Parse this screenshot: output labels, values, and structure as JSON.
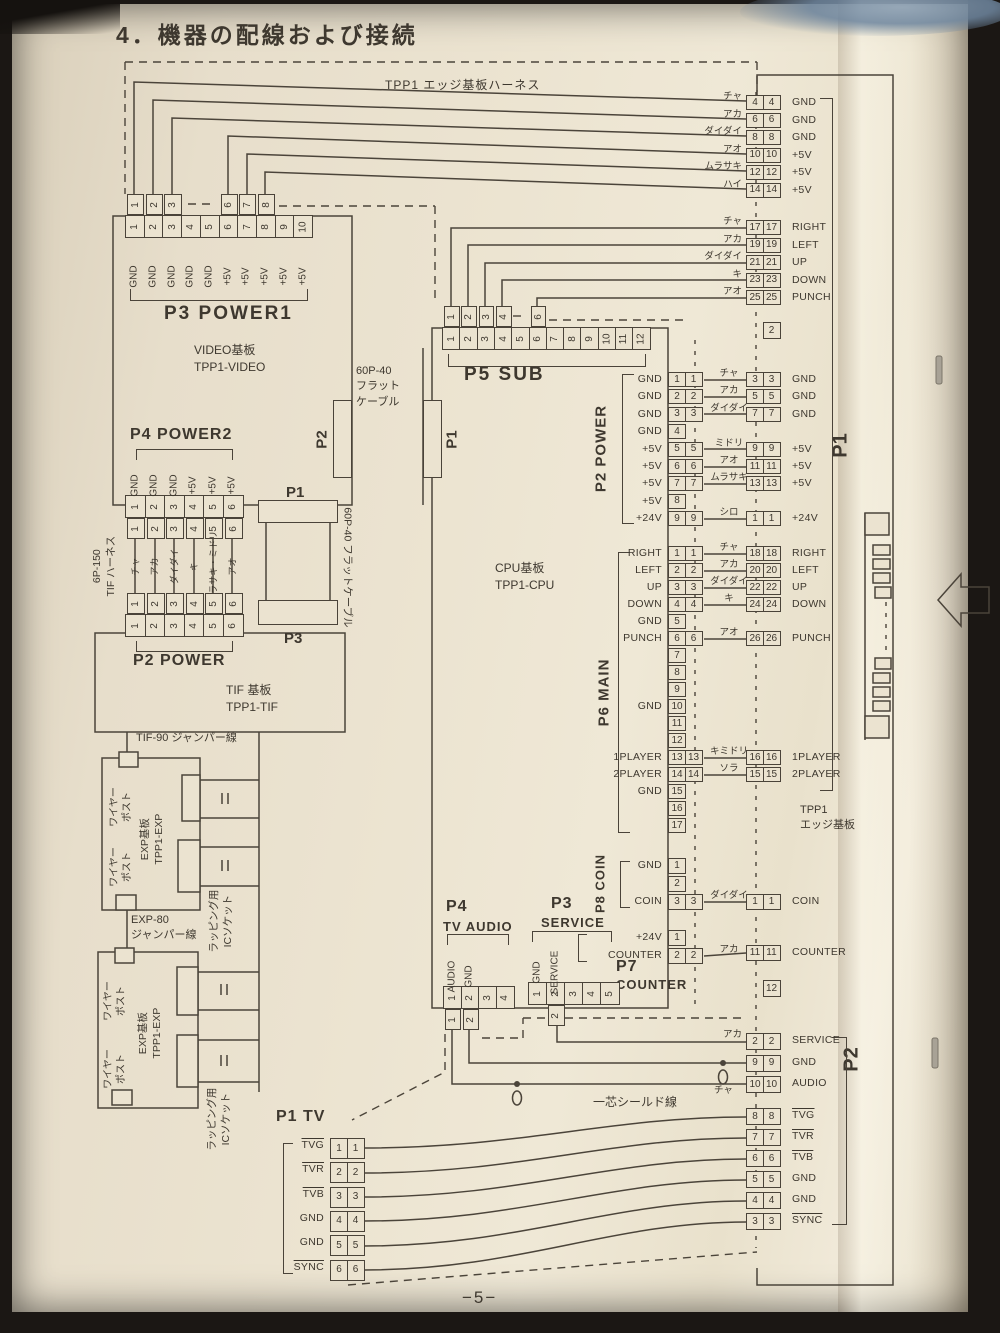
{
  "page": {
    "title": "4．機器の配線および接続",
    "harness_label": "TPP1 エッジ基板ハーネス",
    "page_number": "−5−"
  },
  "boards": {
    "video": [
      "VIDEO基板",
      "TPP1-VIDEO"
    ],
    "cpu": [
      "CPU基板",
      "TPP1-CPU"
    ],
    "tif": [
      "TIF 基板",
      "TPP1-TIF"
    ],
    "exp": [
      "EXP基板",
      "TPP1-EXP"
    ],
    "edge": [
      "TPP1",
      "エッジ基板"
    ]
  },
  "labels": {
    "flat_top": [
      "60P-40",
      "フラット",
      "ケーブル"
    ],
    "flat_side": "60P-40 フラットケーブル",
    "tif_harness": [
      "6P-150",
      "TIF ハーネス"
    ],
    "tif90": "TIF-90 ジャンパー線",
    "exp80": [
      "EXP-80",
      "ジャンパー線"
    ],
    "wire_post": [
      "ワイヤー",
      "ポスト"
    ],
    "ic_socket": [
      "ラッピング用",
      "ICソケット"
    ],
    "shield": "一芯シールド線",
    "cha": "チャ",
    "conn_p2": "P2",
    "conn_p1": "P1",
    "conn_p1b": "P1",
    "conn_p3": "P3",
    "edge_p1": "P1",
    "edge_p2": "P2"
  },
  "connectors": {
    "p3_power1": {
      "title": "P3 POWER1",
      "pins": [
        {
          "n": "1",
          "s": "GND"
        },
        {
          "n": "2",
          "s": "GND"
        },
        {
          "n": "3",
          "s": "GND"
        },
        {
          "n": "4",
          "s": "GND"
        },
        {
          "n": "5",
          "s": "GND"
        },
        {
          "n": "6",
          "s": "+5V"
        },
        {
          "n": "7",
          "s": "+5V"
        },
        {
          "n": "8",
          "s": "+5V"
        },
        {
          "n": "9",
          "s": "+5V"
        },
        {
          "n": "10",
          "s": "+5V"
        }
      ],
      "harness": [
        "1",
        "2",
        "3",
        "",
        "",
        "6",
        "7",
        "8",
        "",
        ""
      ]
    },
    "p4_power2": {
      "title": "P4 POWER2",
      "pins": [
        {
          "n": "1",
          "s": "GND"
        },
        {
          "n": "2",
          "s": "GND"
        },
        {
          "n": "3",
          "s": "GND"
        },
        {
          "n": "4",
          "s": "+5V"
        },
        {
          "n": "5",
          "s": "+5V"
        },
        {
          "n": "6",
          "s": "+5V"
        }
      ],
      "harness": [
        "1",
        "2",
        "3",
        "4",
        "5",
        "6"
      ],
      "wire_colors": [
        "チャ",
        "アカ",
        "ダイダイ",
        "キ",
        "ムラサキ・ミドリ",
        "アオ"
      ]
    },
    "p2_power_tif": {
      "title": "P2 POWER",
      "pins": [
        {
          "n": "1"
        },
        {
          "n": "2"
        },
        {
          "n": "3"
        },
        {
          "n": "4"
        },
        {
          "n": "5"
        },
        {
          "n": "6"
        }
      ],
      "harness": [
        "1",
        "2",
        "3",
        "4",
        "5",
        "6"
      ]
    },
    "p5_sub": {
      "title": "P5 SUB",
      "pins": [
        {
          "n": "1"
        },
        {
          "n": "2"
        },
        {
          "n": "3"
        },
        {
          "n": "4"
        },
        {
          "n": "5"
        },
        {
          "n": "6"
        },
        {
          "n": "7"
        },
        {
          "n": "8"
        },
        {
          "n": "9"
        },
        {
          "n": "10"
        },
        {
          "n": "11"
        },
        {
          "n": "12"
        }
      ],
      "harness": [
        "1",
        "2",
        "3",
        "4",
        "",
        "6",
        "",
        "",
        "",
        "",
        "",
        ""
      ]
    },
    "p4_tv_audio": {
      "title": "P4",
      "title2": "TV AUDIO",
      "pins": [
        {
          "n": "1",
          "s": "AUDIO"
        },
        {
          "n": "2",
          "s": "GND"
        },
        {
          "n": "3"
        },
        {
          "n": "4"
        }
      ],
      "harness": [
        "1",
        "2",
        "",
        ""
      ]
    },
    "p3_service": {
      "title": "P3",
      "title2": "SERVICE",
      "pins": [
        {
          "n": "1",
          "s": "GND"
        },
        {
          "n": "2",
          "s": "SERVICE"
        },
        {
          "n": "3"
        },
        {
          "n": "4"
        },
        {
          "n": "5"
        }
      ],
      "harness": [
        "",
        "2",
        "",
        "",
        ""
      ]
    },
    "p7_counter": {
      "title": "P7",
      "title2": "COUNTER",
      "rows": [
        {
          "s": "+24V",
          "a": "1"
        },
        {
          "s": "COUNTER",
          "a": "2",
          "b": "2",
          "c": "アカ"
        }
      ]
    },
    "p8_coin": {
      "title": "P8 COIN",
      "rows": [
        {
          "s": "GND",
          "a": "1"
        },
        {
          "a": "2"
        },
        {
          "s": "COIN",
          "a": "3",
          "b": "3",
          "c": "ダイダイ"
        }
      ]
    },
    "p2_power_cpu": {
      "title": "P2 POWER",
      "rows": [
        {
          "s": "GND",
          "a": "1",
          "b": "1",
          "c": "チャ"
        },
        {
          "s": "GND",
          "a": "2",
          "b": "2",
          "c": "アカ"
        },
        {
          "s": "GND",
          "a": "3",
          "b": "3",
          "c": "ダイダイ"
        },
        {
          "s": "GND",
          "a": "4"
        },
        {
          "s": "+5V",
          "a": "5",
          "b": "5",
          "c": "ミドリ"
        },
        {
          "s": "+5V",
          "a": "6",
          "b": "6",
          "c": "アオ"
        },
        {
          "s": "+5V",
          "a": "7",
          "b": "7",
          "c": "ムラサキ"
        },
        {
          "s": "+5V",
          "a": "8"
        },
        {
          "s": "+24V",
          "a": "9",
          "b": "9",
          "c": "シロ"
        }
      ]
    },
    "p6_main": {
      "title": "P6 MAIN",
      "rows": [
        {
          "s": "RIGHT",
          "a": "1",
          "b": "1",
          "c": "チャ"
        },
        {
          "s": "LEFT",
          "a": "2",
          "b": "2",
          "c": "アカ"
        },
        {
          "s": "UP",
          "a": "3",
          "b": "3",
          "c": "ダイダイ"
        },
        {
          "s": "DOWN",
          "a": "4",
          "b": "4",
          "c": "キ"
        },
        {
          "s": "GND",
          "a": "5"
        },
        {
          "s": "PUNCH",
          "a": "6",
          "b": "6",
          "c": "アオ"
        },
        {
          "a": "7"
        },
        {
          "a": "8"
        },
        {
          "a": "9"
        },
        {
          "s": "GND",
          "a": "10"
        },
        {
          "a": "11"
        },
        {
          "a": "12"
        },
        {
          "s": "1PLAYER",
          "a": "13",
          "b": "13",
          "c": "キミドリ"
        },
        {
          "s": "2PLAYER",
          "a": "14",
          "b": "14",
          "c": "ソラ"
        },
        {
          "s": "GND",
          "a": "15"
        },
        {
          "a": "16"
        },
        {
          "a": "17"
        }
      ]
    },
    "p1_tv": {
      "title": "P1 TV",
      "rows": [
        {
          "s": "TVG",
          "ov": 1,
          "a": "1",
          "b": "1"
        },
        {
          "s": "TVR",
          "ov": 1,
          "a": "2",
          "b": "2"
        },
        {
          "s": "TVB",
          "ov": 1,
          "a": "3",
          "b": "3"
        },
        {
          "s": "GND",
          "a": "4",
          "b": "4"
        },
        {
          "s": "GND",
          "a": "5",
          "b": "5"
        },
        {
          "s": "SYNC",
          "ov": 1,
          "a": "6",
          "b": "6"
        }
      ]
    }
  },
  "edge_strip": {
    "g1": [
      {
        "c": "チャ",
        "a": "4",
        "b": "4",
        "s": "GND"
      },
      {
        "c": "アカ",
        "a": "6",
        "b": "6",
        "s": "GND"
      },
      {
        "c": "ダイダイ",
        "a": "8",
        "b": "8",
        "s": "GND"
      },
      {
        "c": "アオ",
        "a": "10",
        "b": "10",
        "s": "+5V"
      },
      {
        "c": "ムラサキ",
        "a": "12",
        "b": "12",
        "s": "+5V"
      },
      {
        "c": "ハイ",
        "a": "14",
        "b": "14",
        "s": "+5V"
      }
    ],
    "g2": [
      {
        "c": "チャ",
        "a": "17",
        "b": "17",
        "s": "RIGHT"
      },
      {
        "c": "アカ",
        "a": "19",
        "b": "19",
        "s": "LEFT"
      },
      {
        "c": "ダイダイ",
        "a": "21",
        "b": "21",
        "s": "UP"
      },
      {
        "c": "キ",
        "a": "23",
        "b": "23",
        "s": "DOWN"
      },
      {
        "c": "アオ",
        "a": "25",
        "b": "25",
        "s": "PUNCH"
      }
    ],
    "single2": [
      {
        "b": "2"
      }
    ],
    "power": [
      {
        "a": "3",
        "b": "3",
        "s": "GND"
      },
      {
        "a": "5",
        "b": "5",
        "s": "GND"
      },
      {
        "a": "7",
        "b": "7",
        "s": "GND"
      },
      {
        "gap": true
      },
      {
        "a": "9",
        "b": "9",
        "s": "+5V"
      },
      {
        "a": "11",
        "b": "11",
        "s": "+5V"
      },
      {
        "a": "13",
        "b": "13",
        "s": "+5V"
      },
      {
        "gap": true
      },
      {
        "a": "1",
        "b": "1",
        "s": "+24V"
      }
    ],
    "main": [
      {
        "a": "18",
        "b": "18",
        "s": "RIGHT"
      },
      {
        "a": "20",
        "b": "20",
        "s": "LEFT"
      },
      {
        "a": "22",
        "b": "22",
        "s": "UP"
      },
      {
        "a": "24",
        "b": "24",
        "s": "DOWN"
      },
      {
        "gap": true
      },
      {
        "a": "26",
        "b": "26",
        "s": "PUNCH"
      },
      {
        "gap": true
      },
      {
        "gap": true
      },
      {
        "gap": true
      },
      {
        "gap": true
      },
      {
        "gap": true
      },
      {
        "gap": true
      },
      {
        "a": "16",
        "b": "16",
        "s": "1PLAYER"
      },
      {
        "a": "15",
        "b": "15",
        "s": "2PLAYER"
      }
    ],
    "coin": [
      {
        "a": "1",
        "b": "1",
        "s": "COIN"
      }
    ],
    "counter": [
      {
        "a": "11",
        "b": "11",
        "s": "COUNTER"
      }
    ],
    "single12": [
      {
        "b": "12"
      }
    ],
    "service": [
      {
        "c": "アカ",
        "a": "2",
        "b": "2",
        "s": "SERVICE"
      },
      {
        "a": "9",
        "b": "9",
        "s": "GND"
      },
      {
        "a": "10",
        "b": "10",
        "s": "AUDIO"
      }
    ],
    "tv": [
      {
        "a": "8",
        "b": "8",
        "s": "TVG",
        "ov": 1
      },
      {
        "a": "7",
        "b": "7",
        "s": "TVR",
        "ov": 1
      },
      {
        "a": "6",
        "b": "6",
        "s": "TVB",
        "ov": 1
      },
      {
        "a": "5",
        "b": "5",
        "s": "GND"
      },
      {
        "a": "4",
        "b": "4",
        "s": "GND"
      },
      {
        "a": "3",
        "b": "3",
        "s": "SYNC",
        "ov": 1
      }
    ]
  }
}
